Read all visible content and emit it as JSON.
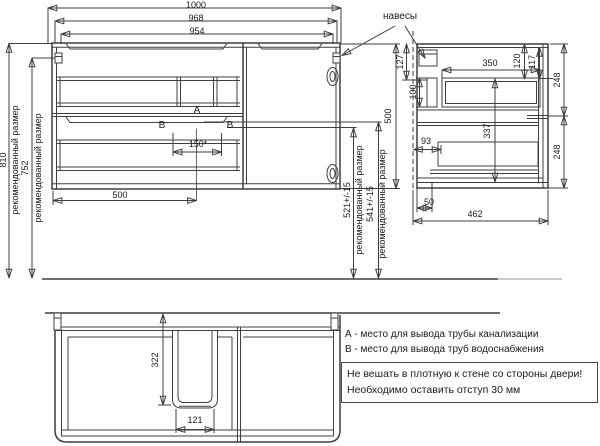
{
  "dims": {
    "top_overall": "1000",
    "top_mid": "968",
    "top_inner": "954",
    "left_height": "810",
    "left_height2": "752",
    "recommended_label": "рекомендованный размер",
    "right_h1": "521+/-15",
    "right_h2": "541+/-15",
    "side_height": "500",
    "front_bottom": "500",
    "holes_span": "150*",
    "side_offset_top": "127",
    "side_bracket": "100",
    "side_drawer_depth": "350",
    "side_120": "120",
    "side_117": "117",
    "side_337": "337",
    "side_93": "93",
    "side_front_top": "248",
    "side_front_bottom": "248",
    "side_50": "50",
    "side_depth": "462",
    "plan_recess_depth": "322",
    "plan_recess_width": "121"
  },
  "markers": {
    "a": "А",
    "b": "В"
  },
  "callouts": {
    "hangers": "навесы"
  },
  "legend": {
    "a": "А - место для вывода трубы канализации",
    "b": "В - место для вывода труб водоснабжения"
  },
  "note": {
    "line1": "Не вешать в плотную к стене со стороны двери!",
    "line2": "Необходимо оставить отступ 30 мм"
  },
  "colors": {
    "marker_a": "#00b33c",
    "marker_b": "#2040cc",
    "line": "#3f3f3f"
  }
}
